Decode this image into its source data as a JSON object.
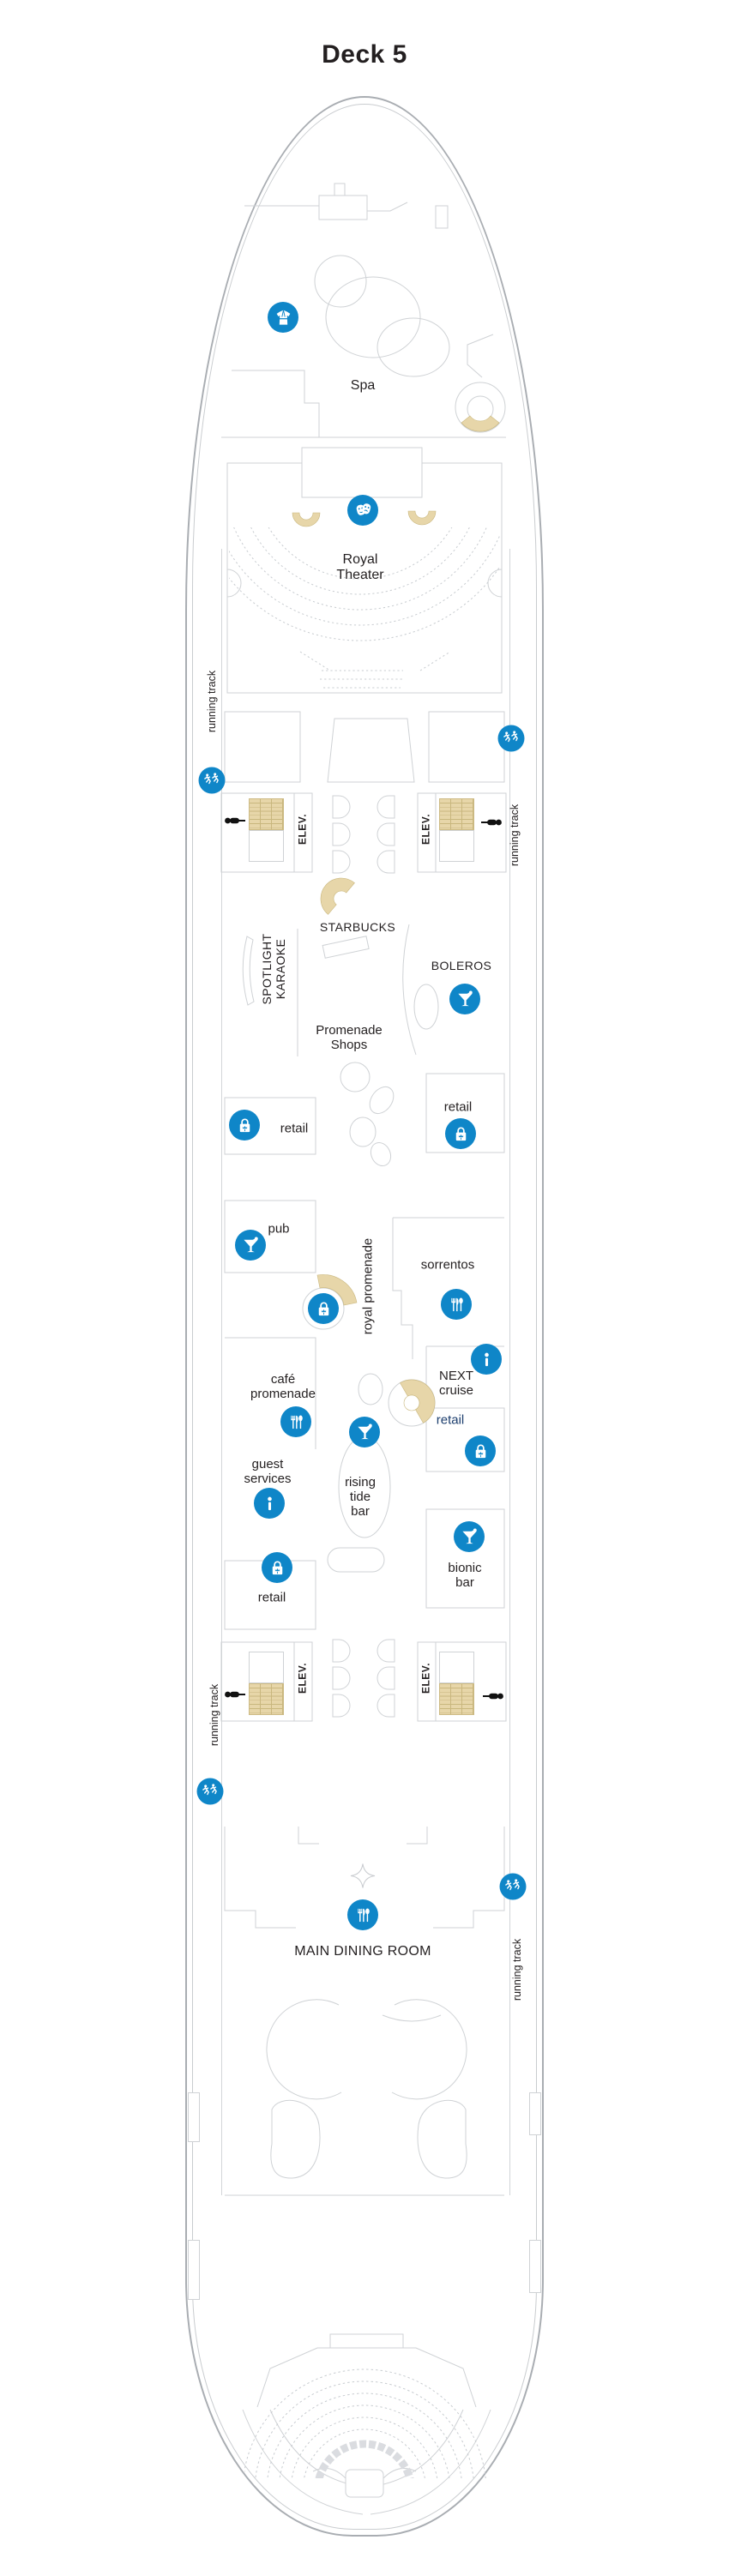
{
  "title": "Deck 5",
  "colors": {
    "accent_blue": "#0f86c8",
    "navy_text": "#1c3e6e",
    "stair_tan": "#e7d6a9",
    "outline_gray": "#cfd2d5",
    "hull_gray": "#a9adb2",
    "text": "#231f20"
  },
  "track": {
    "label": "running track",
    "icon": "runner-icon"
  },
  "elevators": {
    "label": "ELEV."
  },
  "venues": {
    "spa": {
      "label": "Spa",
      "icon": "robe-icon"
    },
    "royal_theater": {
      "label": "Royal Theater",
      "icon": "theater-masks-icon"
    },
    "starbucks": {
      "label": "STARBUCKS"
    },
    "spotlight_karaoke": {
      "label": "SPOTLIGHT KARAOKE"
    },
    "boleros": {
      "label": "BOLEROS",
      "icon": "martini-icon"
    },
    "promenade_shops": {
      "label": "Promenade Shops"
    },
    "retail": {
      "label": "retail",
      "icon": "shopping-bag-icon"
    },
    "pub": {
      "label": "pub",
      "icon": "martini-icon"
    },
    "royal_promenade": {
      "label": "royal promenade",
      "icon": "shopping-bag-icon"
    },
    "sorrentos": {
      "label": "sorrentos",
      "icon": "dining-icon"
    },
    "next_cruise": {
      "label": "NEXT cruise",
      "icon": "info-icon"
    },
    "cafe_promenade": {
      "label": "café promenade",
      "icon": "dining-icon"
    },
    "guest_services": {
      "label": "guest services",
      "icon": "info-icon"
    },
    "rising_tide_bar": {
      "label": "rising tide bar",
      "icon": "martini-icon"
    },
    "bionic_bar": {
      "label": "bionic bar",
      "icon": "martini-icon"
    },
    "main_dining_room": {
      "label": "MAIN DINING ROOM",
      "icon": "dining-icon"
    }
  }
}
